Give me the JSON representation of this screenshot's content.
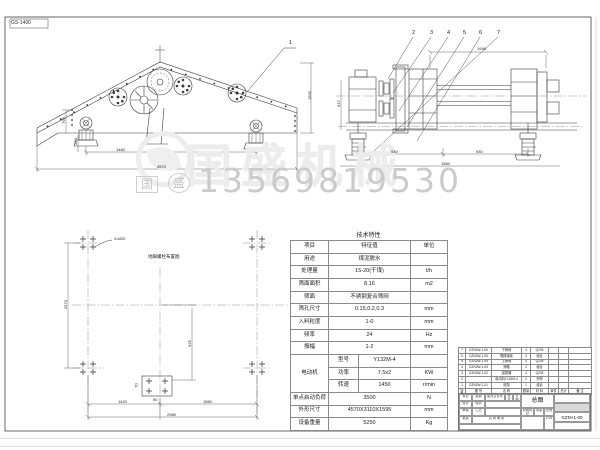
{
  "page": {
    "sheet_label": "GS-1400"
  },
  "watermark": {
    "brand": "国盛机械",
    "phone": "13569819530",
    "stamps": [
      "国",
      "盛"
    ]
  },
  "views": {
    "side": {
      "callout": "1",
      "dims": {
        "h1": "795",
        "h2": "250",
        "w1": "1460",
        "w2": "4570",
        "right_h": "1595"
      }
    },
    "end": {
      "callouts": [
        "2",
        "3",
        "4",
        "5",
        "6",
        "7"
      ],
      "dims": {
        "top": "1946",
        "left": "517",
        "b1": "930",
        "b2": "930",
        "b3": "1560"
      }
    },
    "plan": {
      "title": "地脚螺栓布置图",
      "bolt_note": "4-M20",
      "dims": {
        "left": "2570",
        "v": "925",
        "w1": "1420",
        "w2": "1560",
        "w3": "2980",
        "c1": "90",
        "c2": "70"
      }
    }
  },
  "tech_table": {
    "title": "技术特性",
    "header": {
      "item": "项目",
      "value": "特征值",
      "unit": "单位"
    },
    "rows": [
      {
        "item": "用途",
        "value": "煤泥脱水",
        "unit": ""
      },
      {
        "item": "处理量",
        "value": "15-20(干煤)",
        "unit": "t/h"
      },
      {
        "item": "筛面面积",
        "value": "8.16",
        "unit": "m2"
      },
      {
        "item": "筛面",
        "value": "不锈钢复合筛网",
        "unit": ""
      },
      {
        "item": "筛孔尺寸",
        "value": "0.15,0.2,0.3",
        "unit": "mm"
      },
      {
        "item": "入料粒度",
        "value": "1-0",
        "unit": "mm"
      },
      {
        "item": "频率",
        "value": "24",
        "unit": "Hz"
      },
      {
        "item": "振幅",
        "value": "1-2",
        "unit": "mm"
      }
    ],
    "motor": {
      "label": "电动机",
      "rows": [
        {
          "k": "型号",
          "v": "Y132M-4",
          "unit": ""
        },
        {
          "k": "功率",
          "v": "7.5x2",
          "unit": "KW"
        },
        {
          "k": "转速",
          "v": "1450",
          "unit": "r/min"
        }
      ]
    },
    "rows2": [
      {
        "item": "单点启动负荷",
        "value": "3500",
        "unit": "N"
      },
      {
        "item": "外形尺寸",
        "value": "4570X3110X1595",
        "unit": "mm"
      },
      {
        "item": "设备重量",
        "value": "5250",
        "unit": "Kg"
      }
    ]
  },
  "bom": {
    "header": {
      "seq": "序号",
      "code": "图 号",
      "name": "名 称",
      "qty": "数量",
      "mat": "材 料",
      "unit_w": "单件",
      "total_w": "总计",
      "note": "备 注"
    },
    "rows": [
      {
        "seq": "7",
        "code": "GZN2W-1-06",
        "name": "下筛网",
        "qty": "4",
        "mat": "Q235",
        "unit_w": "",
        "total_w": "",
        "note": ""
      },
      {
        "seq": "6",
        "code": "GZN2W-1-05",
        "name": "隔振弹簧",
        "qty": "4",
        "mat": "组合",
        "unit_w": "",
        "total_w": "",
        "note": ""
      },
      {
        "seq": "5",
        "code": "GZN2W-1-04",
        "name": "上筛网",
        "qty": "4",
        "mat": "Q235",
        "unit_w": "",
        "total_w": "",
        "note": ""
      },
      {
        "seq": "4",
        "code": "GZN2W-1-03",
        "name": "筛箱",
        "qty": "2",
        "mat": "组合",
        "unit_w": "",
        "total_w": "",
        "note": ""
      },
      {
        "seq": "3",
        "code": "GZN2W-1-02",
        "name": "激振器",
        "qty": "2",
        "mat": "Q235",
        "unit_w": "",
        "total_w": "",
        "note": ""
      },
      {
        "seq": "2",
        "code": "",
        "name": "电动机Y132M-4",
        "qty": "2",
        "mat": "外购",
        "unit_w": "",
        "total_w": "",
        "note": ""
      },
      {
        "seq": "1",
        "code": "GZN2W-1-01",
        "name": "底架",
        "qty": "1",
        "mat": "组合",
        "unit_w": "",
        "total_w": "",
        "note": ""
      }
    ]
  },
  "title_block": {
    "drawing_name": "总图",
    "drawing_no": "GZN×1-00",
    "scale_value": "1:15",
    "cells": {
      "mark": "标记",
      "count": "处数",
      "file_no": "更改文件号",
      "sign": "签字",
      "date": "日期",
      "design": "设计",
      "check": "校对",
      "audit": "审核",
      "craft": "工艺",
      "approve": "批准",
      "stage": "阶段标记",
      "weight": "重量",
      "scale": "比例",
      "sheet": "共 张 第 张"
    }
  }
}
